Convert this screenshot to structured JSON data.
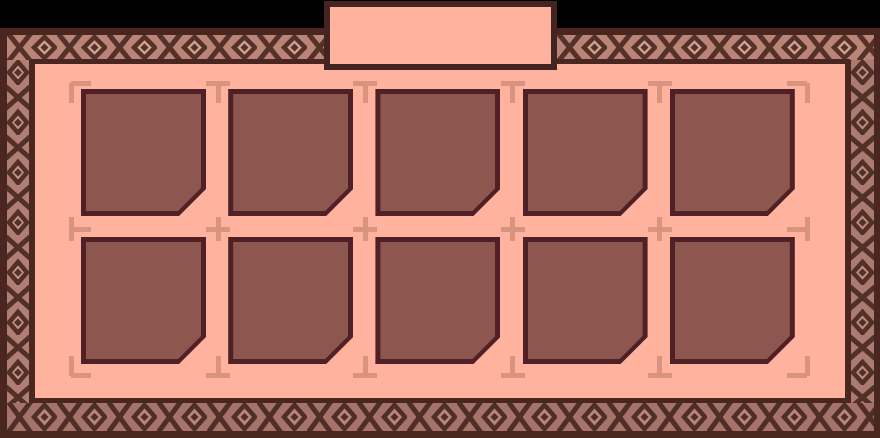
{
  "window": {
    "title_tab_label": ""
  },
  "inventory": {
    "rows": 2,
    "columns": 5,
    "slot_count": 10,
    "slots": [
      {
        "id": 1,
        "row": 0,
        "col": 0,
        "content": ""
      },
      {
        "id": 2,
        "row": 0,
        "col": 1,
        "content": ""
      },
      {
        "id": 3,
        "row": 0,
        "col": 2,
        "content": ""
      },
      {
        "id": 4,
        "row": 0,
        "col": 3,
        "content": ""
      },
      {
        "id": 5,
        "row": 0,
        "col": 4,
        "content": ""
      },
      {
        "id": 6,
        "row": 1,
        "col": 0,
        "content": ""
      },
      {
        "id": 7,
        "row": 1,
        "col": 1,
        "content": ""
      },
      {
        "id": 8,
        "row": 1,
        "col": 2,
        "content": ""
      },
      {
        "id": 9,
        "row": 1,
        "col": 3,
        "content": ""
      },
      {
        "id": 10,
        "row": 1,
        "col": 4,
        "content": ""
      }
    ]
  },
  "grid_guides": {
    "corner_icon": "corner-bracket-mark",
    "edge_icon": "tee-mark",
    "intersection_icon": "cross-mark"
  },
  "theme": {
    "background": "#000000",
    "panel_fill": "#ffb29e",
    "frame_dark": "#4a2620",
    "tab_border": "#432420",
    "slot_fill": "#8d574f",
    "slot_border": "#4f2026",
    "mark_color": "#d8947f",
    "border_pattern": {
      "top": {
        "bg": "#ba8476",
        "inner": "#d2a08f",
        "dark": "#543129"
      },
      "left": {
        "bg": "#b07e72",
        "inner": "#c49384",
        "dark": "#523028"
      },
      "right": {
        "bg": "#ab7a70",
        "inner": "#bd8b7e",
        "dark": "#513028"
      },
      "bottom": {
        "bg": "#a6736b",
        "inner": "#b8837a",
        "dark": "#4f2e27"
      }
    }
  }
}
